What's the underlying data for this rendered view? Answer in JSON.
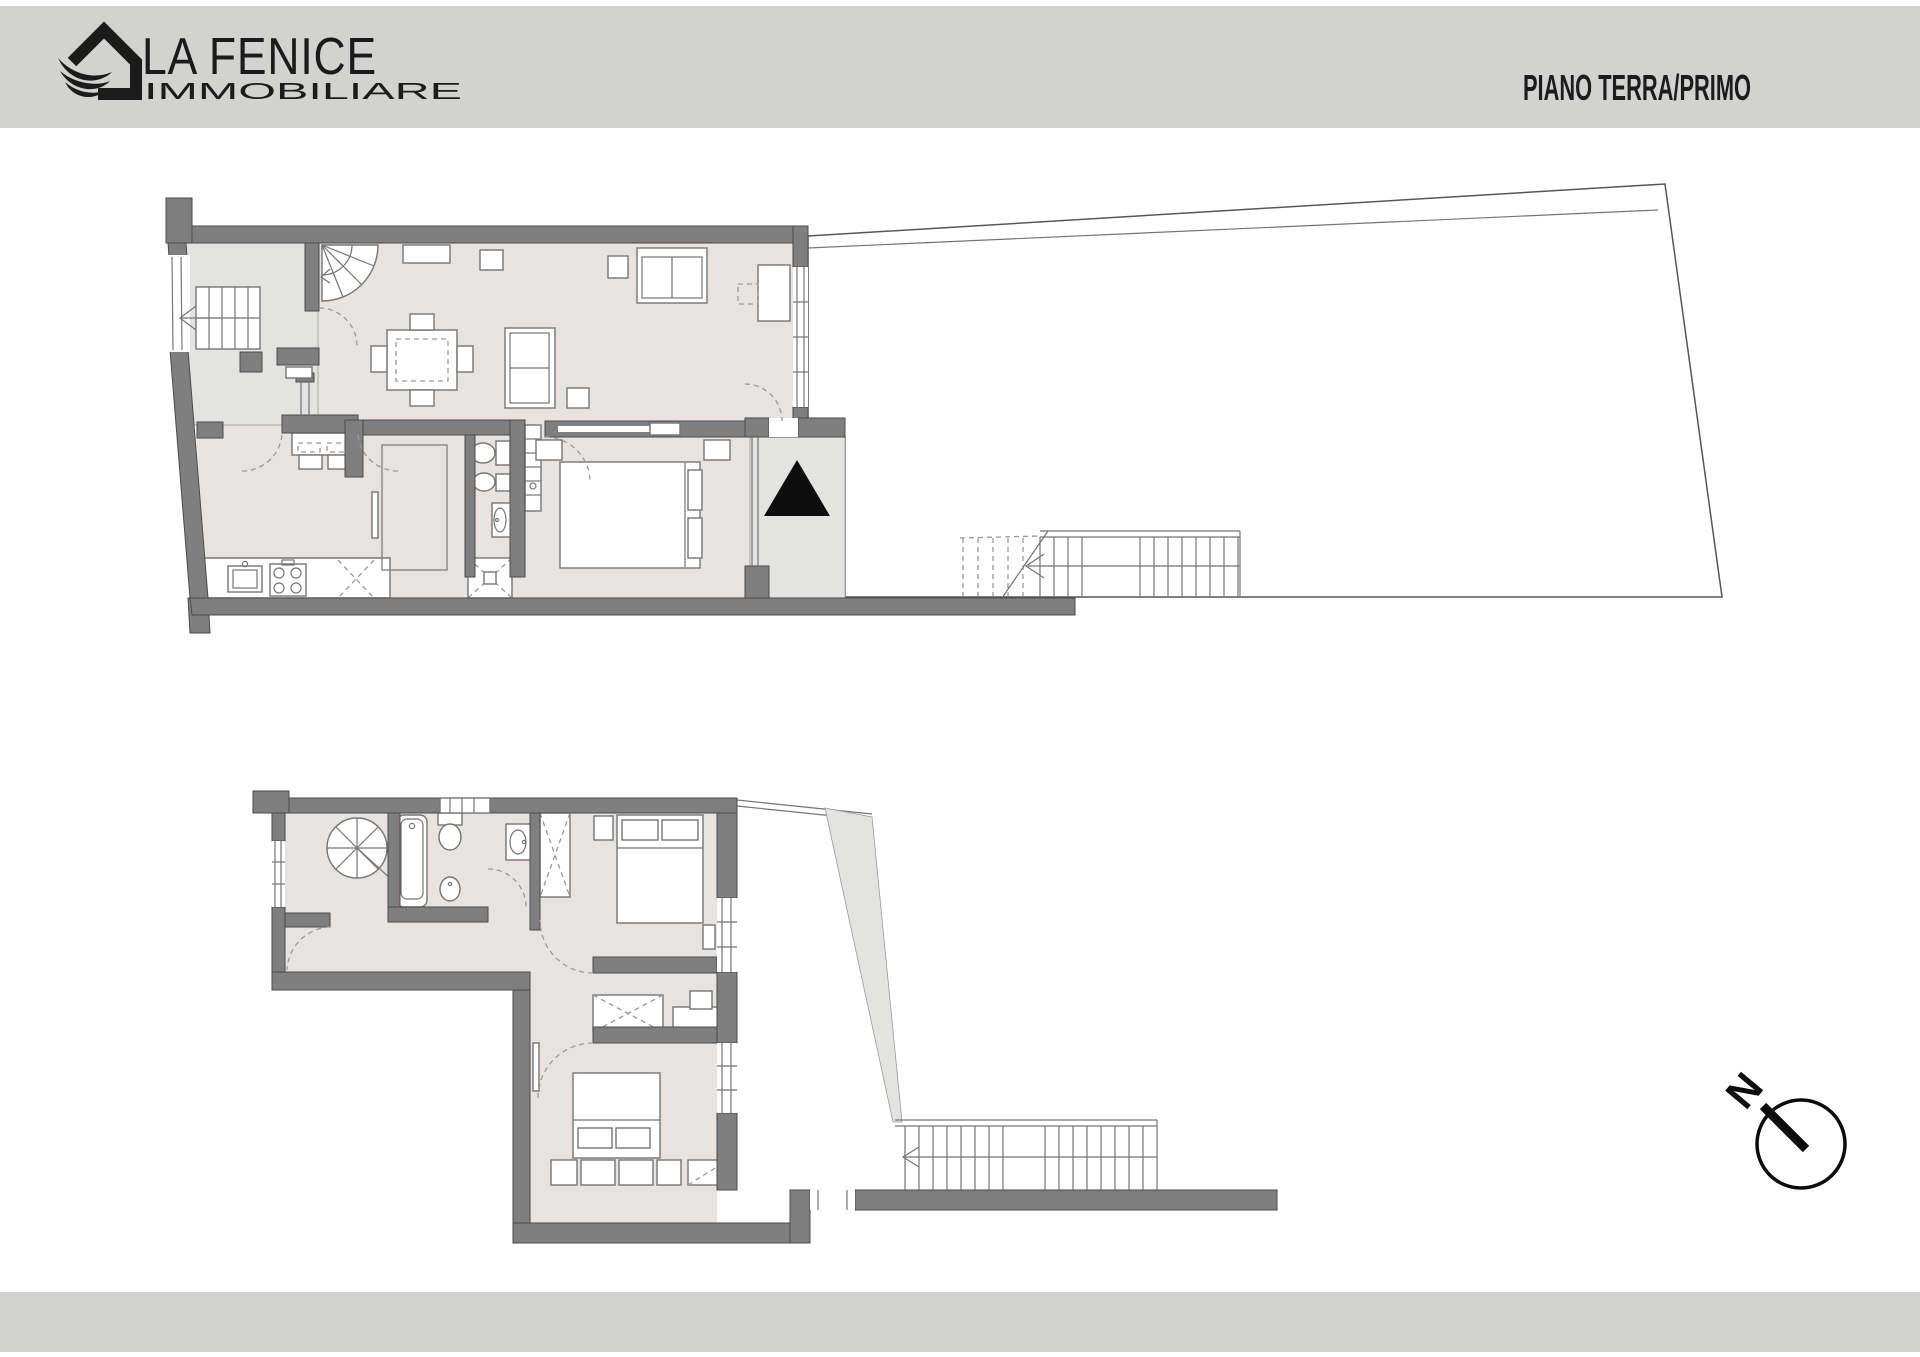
{
  "header": {
    "brand": {
      "name": "LA FENICE",
      "subtitle": "IMMOBILIARE",
      "logo_icon": "house-phoenix-wing-icon"
    },
    "sheet_title": "PIANO TERRA/PRIMO"
  },
  "compass": {
    "north_label": "N",
    "icon": "compass-north-icon"
  },
  "plan_markers": {
    "entrance_triangle_icon": "black-triangle-marker",
    "ground_floor": "floor-plan-ground",
    "first_floor": "floor-plan-first"
  },
  "colors": {
    "band": "#d2d2d0",
    "wall": "#7f7f7f",
    "wall_outline": "#4b4b4b",
    "floor": "#e7e3e0",
    "floor_secondary": "#e3e3e1",
    "marker_black": "#0d0d0d",
    "line": "#757575",
    "text": "#1c1c1c"
  }
}
